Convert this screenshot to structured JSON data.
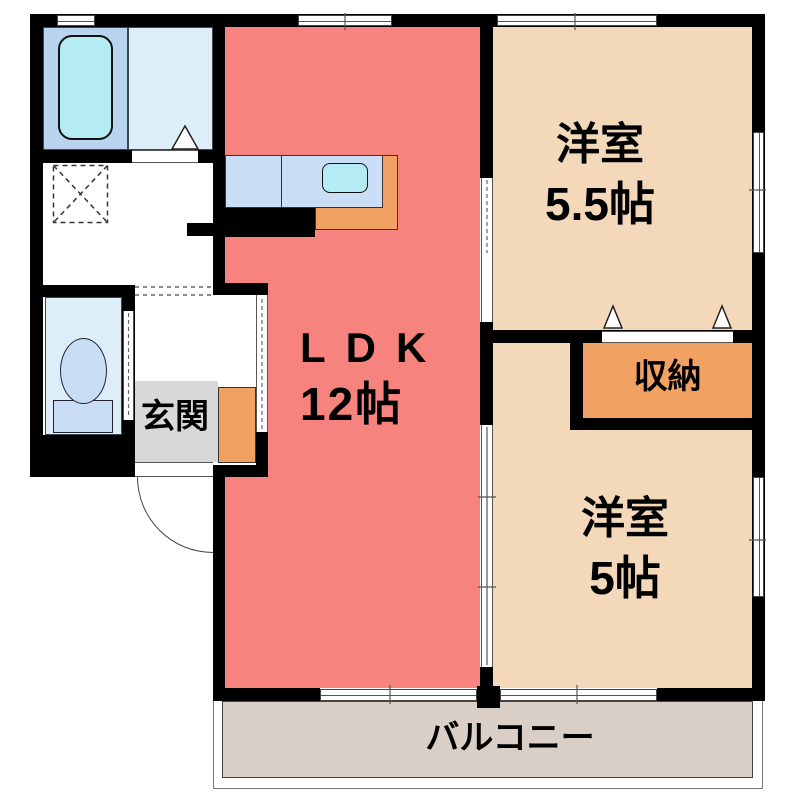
{
  "rooms": {
    "ldk": {
      "label": "LDK",
      "size": "12帖"
    },
    "western_55": {
      "label": "洋室",
      "size": "5.5帖"
    },
    "western_5": {
      "label": "洋室",
      "size": "5帖"
    },
    "storage": {
      "label": "収納"
    },
    "entrance": {
      "label": "玄関"
    },
    "balcony": {
      "label": "バルコニー"
    }
  },
  "fixtures": [
    "bathtub-icon",
    "washing-machine-area-icon",
    "kitchen-sink-icon",
    "toilet-icon"
  ],
  "colors": {
    "ldk": "#f6837e",
    "western_room": "#f3d8ba",
    "storage_orange": "#f1a263",
    "bathroom_blue": "#b9d4ee",
    "washroom_blue": "#deeef9",
    "counter_blue": "#cadef5",
    "sink_cyan": "#b5ebf2",
    "toilet_fixture_blue": "#c9def5",
    "entrance_gray": "#d8d8d8",
    "balcony_beige": "#d9cfc7",
    "wall": "#000000"
  }
}
